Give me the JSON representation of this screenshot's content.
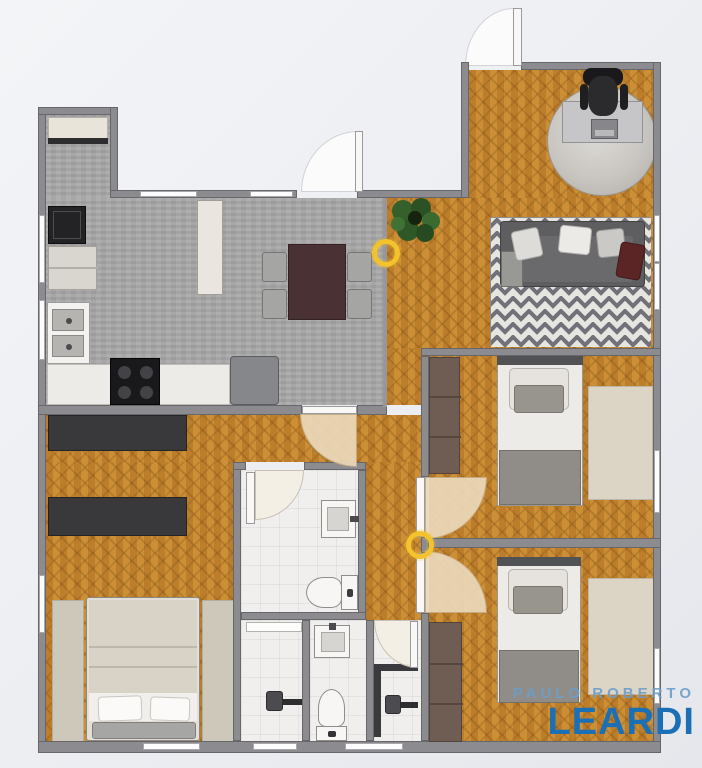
{
  "watermark": {
    "line1": "PAULO ROBERTO",
    "line2": "LEARDI",
    "line1_color": "#6c9dc8",
    "line2_color": "#1b6fb5"
  },
  "markers": [
    {
      "name": "viewpoint-marker-living",
      "color": "#f3c22c"
    },
    {
      "name": "viewpoint-marker-hallway",
      "color": "#f3c22c"
    }
  ],
  "palette": {
    "background": "#eef0f4",
    "wall": "#8b8b90",
    "wood_floor": "#c6892f",
    "kitchen_floor": "#a7a7a7",
    "bathroom_floor": "#f0efed",
    "door_swing": "#ead8ba",
    "accent_yellow": "#f3c22c",
    "sofa": "#5e5e61",
    "dining_table": "#4a3134"
  },
  "rooms": [
    {
      "name": "service-area",
      "furniture": [
        "counter",
        "washing-machine",
        "appliance",
        "tall-cabinet"
      ]
    },
    {
      "name": "kitchen-dining",
      "furniture": [
        "double-sink",
        "counter",
        "cooktop",
        "fridge",
        "dining-table",
        "chair",
        "chair",
        "chair",
        "chair"
      ]
    },
    {
      "name": "living-room",
      "furniture": [
        "round-rug",
        "desk",
        "laptop",
        "office-chair",
        "plant",
        "chevron-rug",
        "sofa",
        "pillows"
      ]
    },
    {
      "name": "master-bedroom",
      "furniture": [
        "wardrobe",
        "wardrobe",
        "double-bed",
        "runner-rug",
        "runner-rug"
      ]
    },
    {
      "name": "bathroom-suite",
      "furniture": [
        "sink",
        "toilet"
      ]
    },
    {
      "name": "shower-stall",
      "furniture": [
        "glass-door",
        "shower-head"
      ]
    },
    {
      "name": "wc",
      "furniture": [
        "sink",
        "toilet"
      ]
    },
    {
      "name": "shower-room",
      "furniture": [
        "shower-enclosure",
        "shower-head"
      ]
    },
    {
      "name": "bedroom-2",
      "furniture": [
        "wardrobe",
        "single-bed",
        "rug"
      ]
    },
    {
      "name": "bedroom-3",
      "furniture": [
        "wardrobe",
        "single-bed",
        "rug"
      ]
    }
  ]
}
